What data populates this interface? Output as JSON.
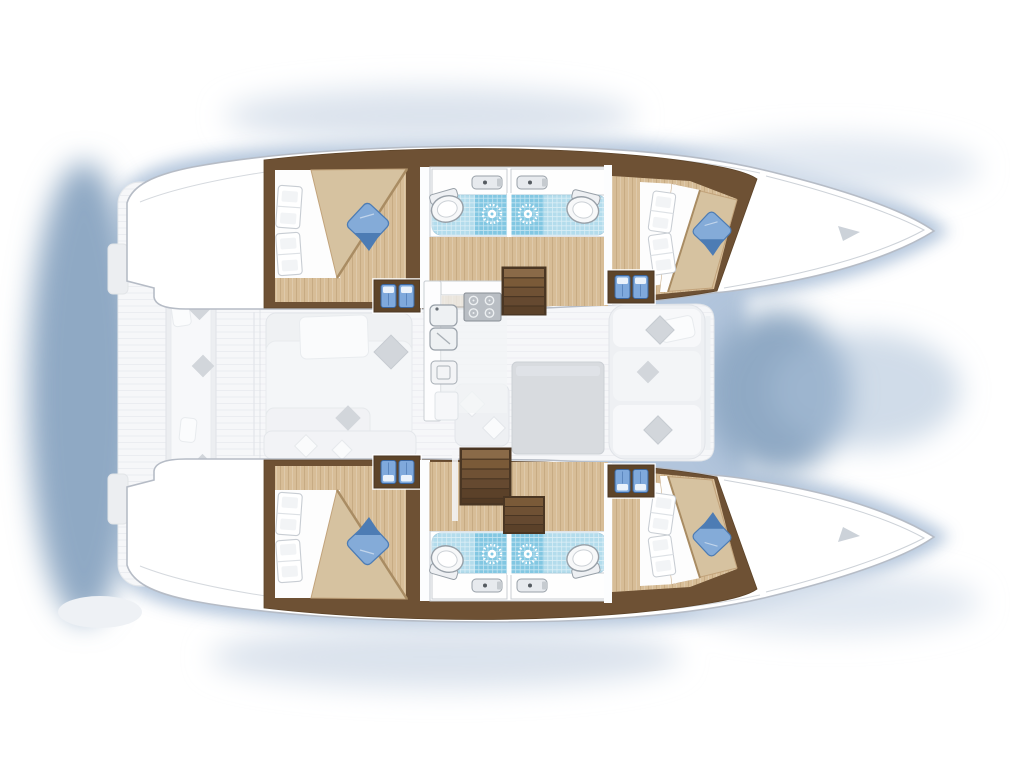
{
  "page": {
    "title": "Catamaran deck plan - 4 cabin layout",
    "description": "Top-down floor plan of a sailing catamaran with bows to the right: two mirrored hulls, each with an aft double cabin, two bathrooms with vanity basin, shower and toilet, and a forward double cabin; central bridgedeck salon with galley (4-burner stove, double sink, oven), dinette table and bench seating, twin companionway stairs down to the hulls; aft cockpit with long bench seat and scatter cushions."
  },
  "colors": {
    "glow": "#aabfd8",
    "glowDeep": "#8fa9c4",
    "glowSoft": "#dbe3ed",
    "hull": "#ffffff",
    "hullStroke": "#b6bcc6",
    "woodDark": "#6e5134",
    "stepBox": "#5d4429",
    "woodFloor": "#d7bd97",
    "woodGrain": "#b4946a",
    "tile": "#b3dcec",
    "shower": "#82c7e2",
    "bedTan": "#d6c2a0",
    "bedTrim": "#a98c63",
    "pillowBlue": "#84abd8",
    "pillowBlueDark": "#4d7cb4",
    "stepIcon": "#7fa9dc",
    "stove": "#b9bec4",
    "fadeFloor": "#f6f7f9",
    "fadeFurniture": "#eceef1",
    "fadePillow": "#d2d6db",
    "fadeTable": "#d8dbdf"
  },
  "plan": {
    "vessel": "catamaran",
    "view": "top-down deck plan",
    "orientation": {
      "bow": "right",
      "stern": "left"
    },
    "hulls": [
      {
        "name": "port-hull",
        "position": "top",
        "rooms": [
          {
            "name": "aft-cabin",
            "items": [
              "double-bed",
              "two-white-pillows",
              "blue-accent-pillow",
              "companionway-steps"
            ]
          },
          {
            "name": "bathroom-aft",
            "items": [
              "vanity-basin",
              "tiled-shower",
              "toilet"
            ]
          },
          {
            "name": "bathroom-forward",
            "items": [
              "vanity-basin",
              "tiled-shower",
              "toilet"
            ]
          },
          {
            "name": "corridor",
            "items": [
              "wood-planked-sole"
            ]
          },
          {
            "name": "forward-cabin",
            "items": [
              "double-bed",
              "two-white-pillows",
              "blue-accent-pillow",
              "companionway-steps"
            ]
          }
        ]
      },
      {
        "name": "starboard-hull",
        "position": "bottom",
        "mirrored_from": "port-hull",
        "rooms": [
          {
            "name": "aft-cabin",
            "items": [
              "double-bed",
              "two-white-pillows",
              "blue-accent-pillow",
              "companionway-steps"
            ]
          },
          {
            "name": "bathroom-aft",
            "items": [
              "vanity-basin",
              "tiled-shower",
              "toilet"
            ]
          },
          {
            "name": "bathroom-forward",
            "items": [
              "vanity-basin",
              "tiled-shower",
              "toilet"
            ]
          },
          {
            "name": "corridor",
            "items": [
              "wood-planked-sole"
            ]
          },
          {
            "name": "forward-cabin",
            "items": [
              "double-bed",
              "two-white-pillows",
              "blue-accent-pillow",
              "companionway-steps"
            ]
          }
        ]
      }
    ],
    "bridgedeck": {
      "name": "salon",
      "items": [
        "galley-counter",
        "four-burner-stove",
        "double-sink",
        "oven",
        "sofa",
        "scatter-cushions",
        "dinette-table",
        "bench-seating",
        "companionway-stairs-port",
        "companionway-stairs-starboard"
      ]
    },
    "cockpit": {
      "name": "aft-cockpit",
      "items": [
        "bench-seat",
        "scatter-cushions",
        "transom-step-port",
        "transom-step-starboard"
      ]
    }
  }
}
